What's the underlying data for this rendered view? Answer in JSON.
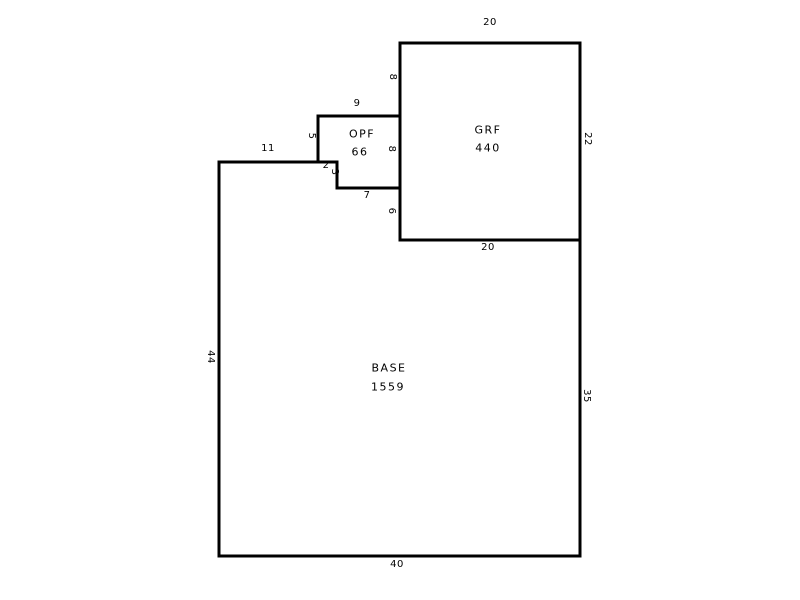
{
  "page": {
    "background": "#ffffff"
  },
  "diagram": {
    "type": "floor-plan-sketch",
    "line_color": "#000000",
    "text_color": "#000000",
    "areas": {
      "grf": {
        "name": "GRF",
        "area": "440"
      },
      "opf": {
        "name": "OPF",
        "area": "66"
      },
      "base": {
        "name": "BASE",
        "area": "1559"
      }
    },
    "dimensions": {
      "grf_top": "20",
      "grf_right": "22",
      "grf_bottom": "20",
      "grf_left_upper": "8",
      "grf_left_lower": "6",
      "opf_top": "9",
      "opf_left": "5",
      "opf_right": "8",
      "opf_bottom": "7",
      "base_top": "11",
      "base_top_step": "2",
      "base_notch": "3",
      "base_left": "44",
      "base_right": "35",
      "base_bottom": "40"
    },
    "shapes": {
      "base_path": "M219 162 H337 V188 H400 V240 H580 V556 H219 Z",
      "opf_path": "M318 116 H400 V188 H337 V162 H318 Z",
      "grf_path": "M400 43 H580 V240 H400 Z"
    }
  }
}
